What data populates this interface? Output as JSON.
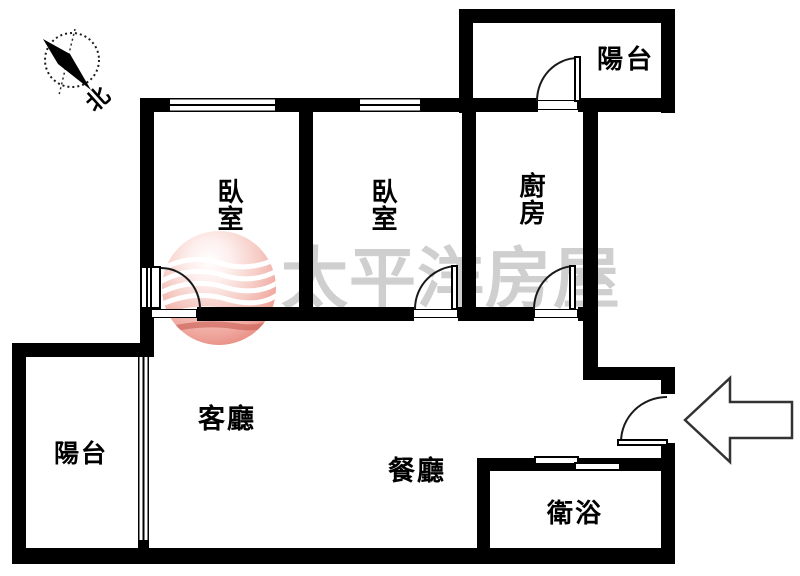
{
  "floorplan": {
    "rooms": {
      "balcony_top": {
        "label": "陽台"
      },
      "bedroom_left": {
        "label": "臥室"
      },
      "bedroom_middle": {
        "label": "臥室"
      },
      "kitchen": {
        "label": "廚房"
      },
      "balcony_bottom_left": {
        "label": "陽台"
      },
      "living_room": {
        "label": "客廳"
      },
      "dining_room": {
        "label": "餐廳"
      },
      "bathroom": {
        "label": "衛浴"
      }
    },
    "compass": {
      "north_label": "北"
    },
    "watermark": {
      "brand_text": "太平洋房屋"
    },
    "colors": {
      "wall": "#000000",
      "watermark_text": "#cbcbcb",
      "logo_red": "#e27468",
      "background": "#ffffff"
    }
  }
}
